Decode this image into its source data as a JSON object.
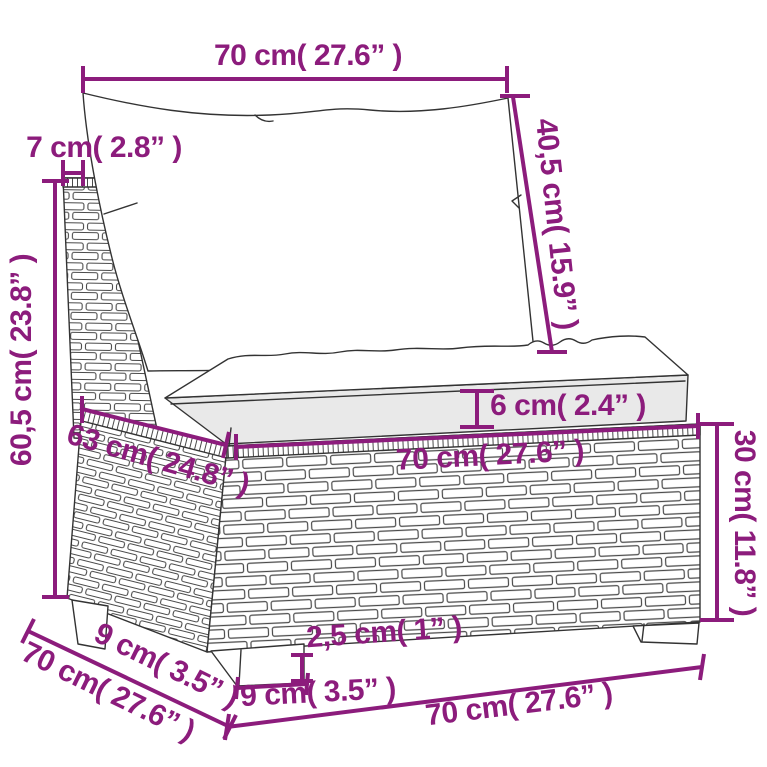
{
  "diagram": {
    "description": "Dimension diagram of a poly rattan middle sofa section with back cushion and seat cushion",
    "colors": {
      "dimension": "#8C1C7C",
      "sketch": "#333333",
      "cushion_shade": "#e9e9e9",
      "background": "#ffffff"
    },
    "labels": {
      "back_cushion_width": "70 cm( 27.6” )",
      "back_panel_thickness": "7 cm( 2.8” )",
      "back_cushion_height": "40,5 cm( 15.9” )",
      "total_height": "60,5 cm( 23.8” )",
      "seat_cushion_thickness": "6 cm( 2.4” )",
      "seat_depth": "63 cm( 24.8” )",
      "seat_width": "70 cm( 27.6” )",
      "base_height": "30 cm( 11.8” )",
      "leg_inset_depth": "9 cm( 3.5” )",
      "total_depth": "70 cm( 27.6” )",
      "leg_height": "2,5 cm( 1” )",
      "leg_width": "9 cm( 3.5” )",
      "total_width": "70 cm( 27.6” )"
    }
  }
}
